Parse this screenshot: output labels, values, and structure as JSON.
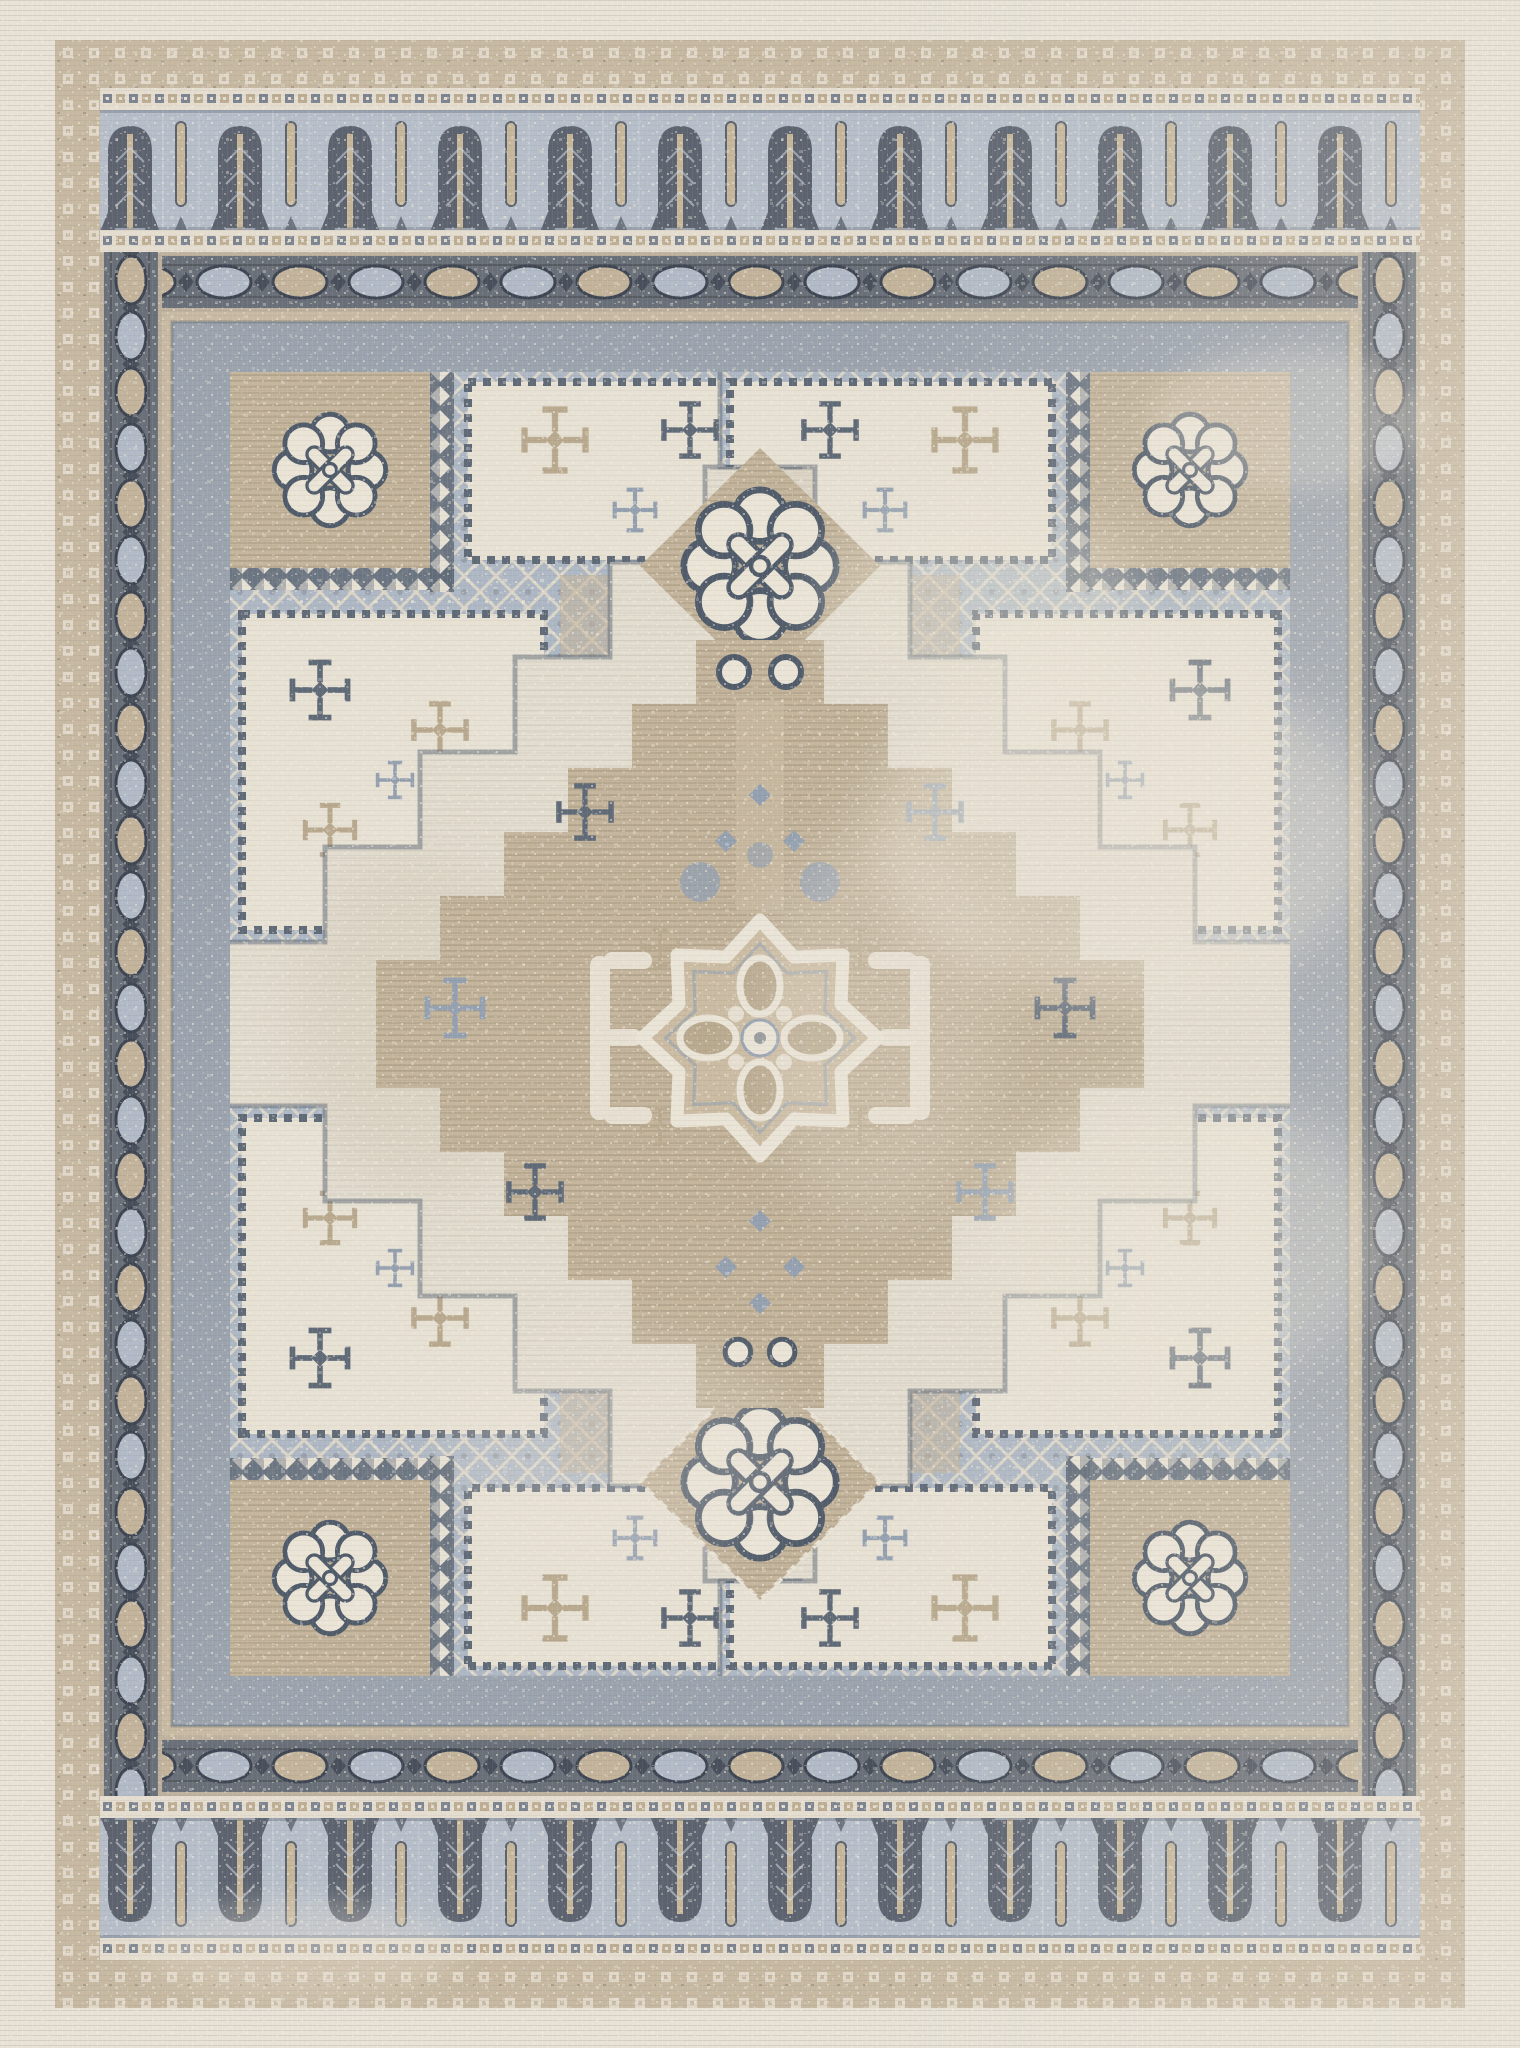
{
  "meta": {
    "title": "Vintage-style distressed area rug, portrait orientation",
    "alt": "Machine-woven oriental rug with cream field, beige and slate-blue palette, comb-and-poplar tree border, diamond chain guard bands, stepped corner spandrels with cross flowers and lattice, two small diamond medallions with interlaced knot rosettes, and a large stepped central diamond medallion with an eight-lobed rosette."
  },
  "rug": {
    "style": "distressed Oushak / Anatolian revival",
    "orientation": "portrait",
    "motifs": [
      "comb-and-poplar border",
      "square-dot guard stripe",
      "diamond chain guard band",
      "vesica chain side band",
      "stepped corner spandrel",
      "diamond lattice",
      "cross flower",
      "interlaced knot rosette",
      "stepped diamond medallion",
      "eight-lobed star medallion",
      "paw-petal rosette",
      "bracket motif"
    ],
    "counts": {
      "poplar_trees_top": 12,
      "poplar_trees_bottom": 12,
      "corner_spandrels": 4,
      "small_diamond_medallions": 2,
      "central_medallions": 1
    }
  },
  "palette": {
    "cream_margin": "#e7e1d6",
    "weave_light": "#f2ecdf",
    "tan_band": "#c6b8a1",
    "band_ring": "#e5ded0",
    "dot_bg": "#e4ddcf",
    "sq_slate": "#7d8591",
    "sq_tan": "#bdae94",
    "comb_bg": "#b6bec9",
    "comb_dark": "#5d6470",
    "comb_stem": "#c6b79b",
    "comb_frond": "#d3d8de",
    "chain_bg": "#6a7079",
    "chain_beige": "#c2b39a",
    "chain_blue": "#b1bac6",
    "chain_dark": "#49505c",
    "edge_beige": "#c8baa2",
    "frame_gray": "#9ba3ae",
    "field_cream": "#e3ddd0",
    "patch_tan": "#cdc2ae",
    "med_tan": "#c4b59c",
    "med_tan2": "#cabba2",
    "lattice_blue": "#aeb8c4",
    "lattice_line": "#dbd5c8",
    "panel_cream": "#e7e1d4",
    "m_slate": "#616b78",
    "m_blue": "#95a1b0",
    "m_beige": "#b9aa8f",
    "knot_cream": "#eae4d7",
    "knot_stroke": "#515c6a",
    "speck": "#f3ede0"
  }
}
